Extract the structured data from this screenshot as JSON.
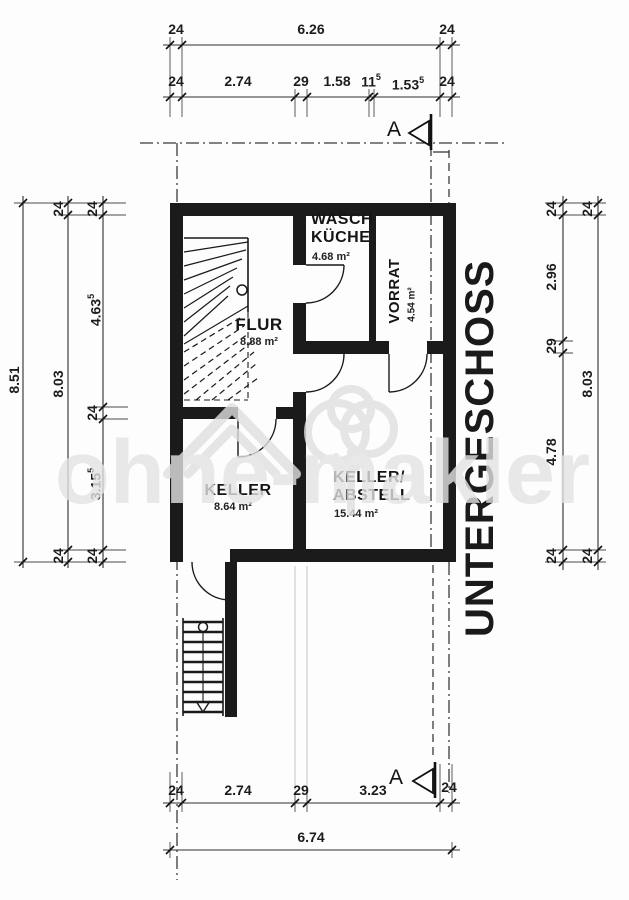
{
  "floor": {
    "label": "UNTERGESCHOSS"
  },
  "watermark": {
    "text": "ohne-makler"
  },
  "section": {
    "label": "A"
  },
  "rooms": {
    "waschkueche": {
      "line1": "WASCH",
      "line2": "KÜCHE",
      "area": "4.68 m²"
    },
    "vorrat": {
      "name": "VORRAT",
      "area": "4.54 m²"
    },
    "flur": {
      "name": "FLUR",
      "area": "8.88 m²"
    },
    "keller": {
      "name": "KELLER",
      "area": "8.64 m²"
    },
    "abstell": {
      "line1": "KELLER/",
      "line2": "ABSTELL",
      "area": "15.44 m²"
    }
  },
  "dims": {
    "top1": {
      "a": "24",
      "b": "6.26",
      "c": "24"
    },
    "top2": {
      "a": "24",
      "b": "2.74",
      "c": "29",
      "d": "1.58",
      "e": "11",
      "e_sup": "5",
      "f": "1.53",
      "f_sup": "5",
      "g": "24"
    },
    "left1": {
      "a": "8.51"
    },
    "left2": {
      "a": "24",
      "b": "8.03",
      "c": "24"
    },
    "left3": {
      "a": "24",
      "b": "4.63",
      "b_sup": "5",
      "c": "24",
      "d": "3.15",
      "d_sup": "5",
      "e": "24"
    },
    "right1": {
      "a": "24",
      "b": "2.96",
      "c": "29",
      "d": "4.78",
      "e": "24"
    },
    "right2": {
      "a": "24",
      "b": "8.03",
      "c": "24"
    },
    "bottom1": {
      "a": "24",
      "b": "2.74",
      "c": "29",
      "d": "3.23",
      "e": "24"
    },
    "bottom2": {
      "a": "6.74"
    }
  }
}
